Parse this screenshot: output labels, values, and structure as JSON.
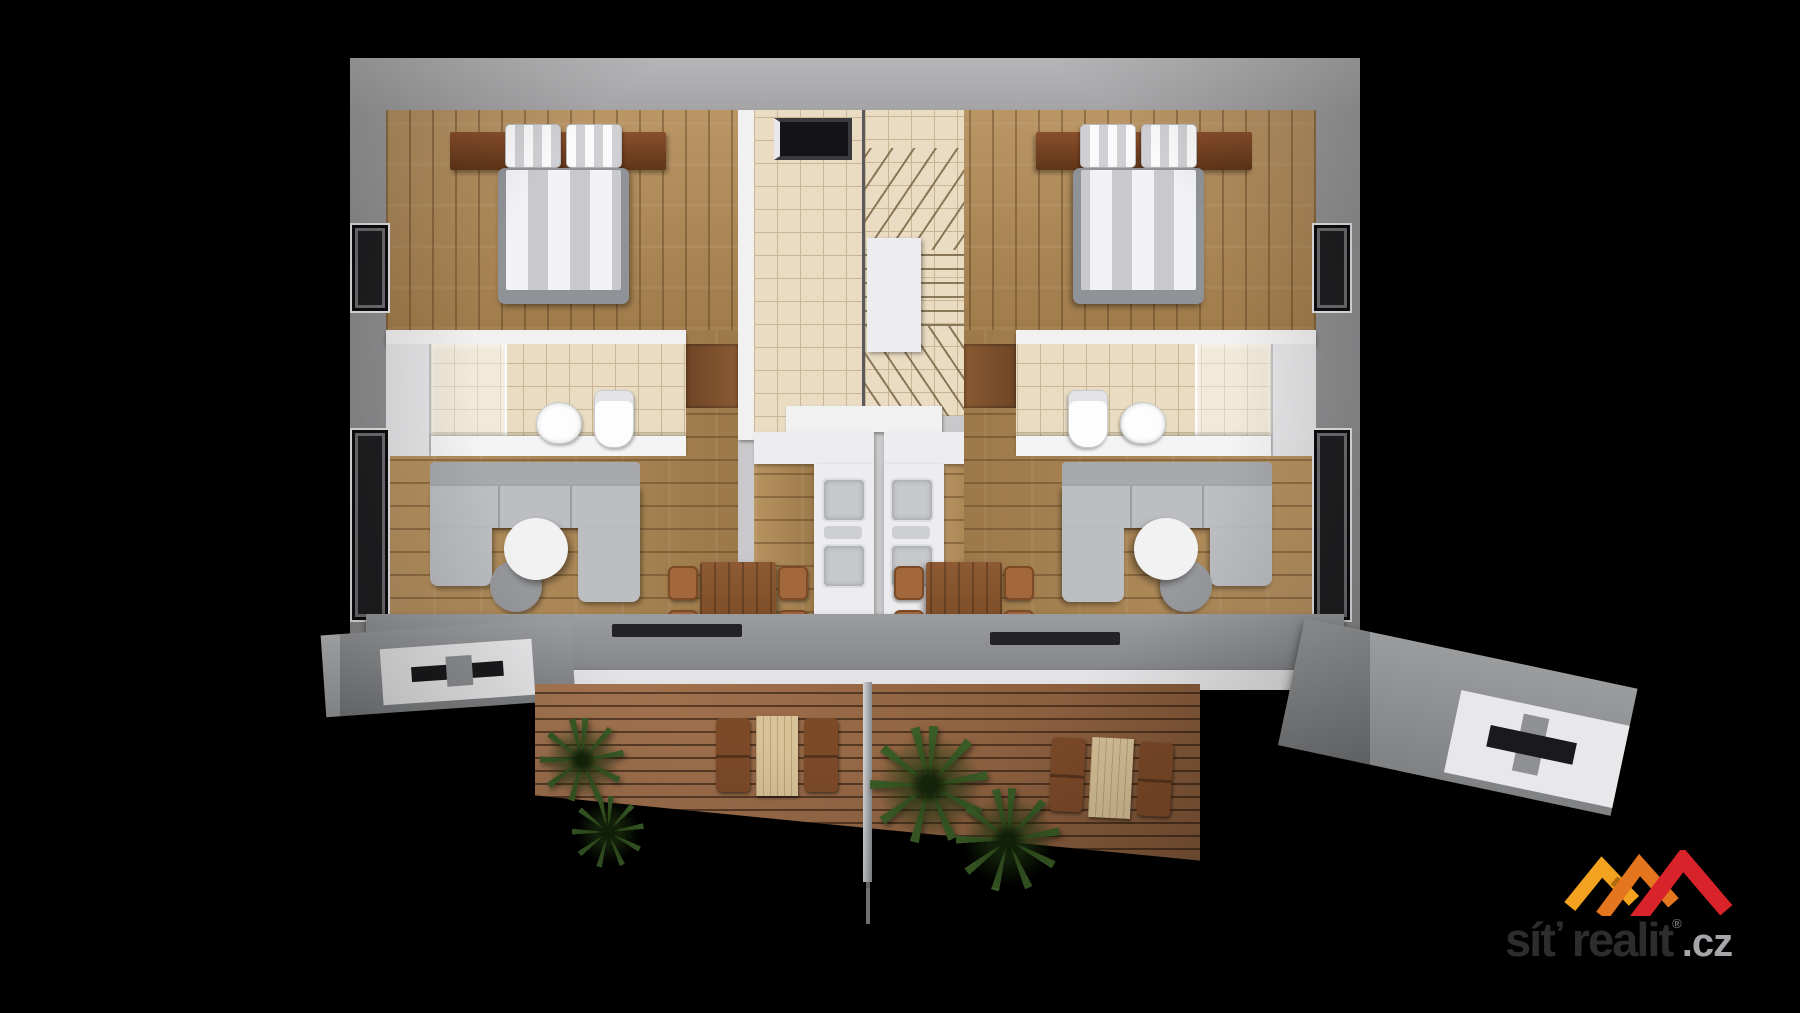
{
  "logo": {
    "brand": "síť realit",
    "registered_mark": "®",
    "tld": ".cz"
  },
  "palette": {
    "background": "#000000",
    "outer_wall": "#9b9b9d",
    "wall_face": "#c9c9cb",
    "white_wall": "#f1f1f2",
    "wood_floor": "#b28a54",
    "tile_floor": "#e9dcc2",
    "tile_line": "#c8b694",
    "sofa_gray": "#bcbec1",
    "sofa_gray_dark": "#a7a9ac",
    "bed_frame": "#8f9296",
    "mattress_light": "#f2f2f4",
    "mattress_dark": "#c9c9cd",
    "headboard_wood": "#7a4527",
    "dining_wood": "#85532e",
    "chair_wood": "#a2683c",
    "counter_white": "#ededef",
    "sink_gray": "#c6c8ca",
    "appliance_gray": "#75777a",
    "deck_wood": "#a06c45",
    "walkway_gray": "#8e9092",
    "rim_white": "#e3e3e5",
    "plant_green": "#3a5c26",
    "window_dark": "#1f1f21",
    "glass_gray": "#6f6f72",
    "outdoor_table_wood": "#d8c298",
    "outdoor_sofa_wood": "#7d4a28",
    "pole_gray": "#b9bbbd",
    "doorway_dark": "#141416",
    "logo_text": "#2d2d2f",
    "logo_tld": "#a4a6a9",
    "roof_yellow": "#f2a21e",
    "roof_orange": "#e4761f",
    "roof_red": "#d8232a"
  },
  "scene": {
    "description": "3D rendered floor plan of two mirrored apartment units with central winder staircase, bathrooms, kitchens and a shared front terrace deck",
    "units": 2
  }
}
